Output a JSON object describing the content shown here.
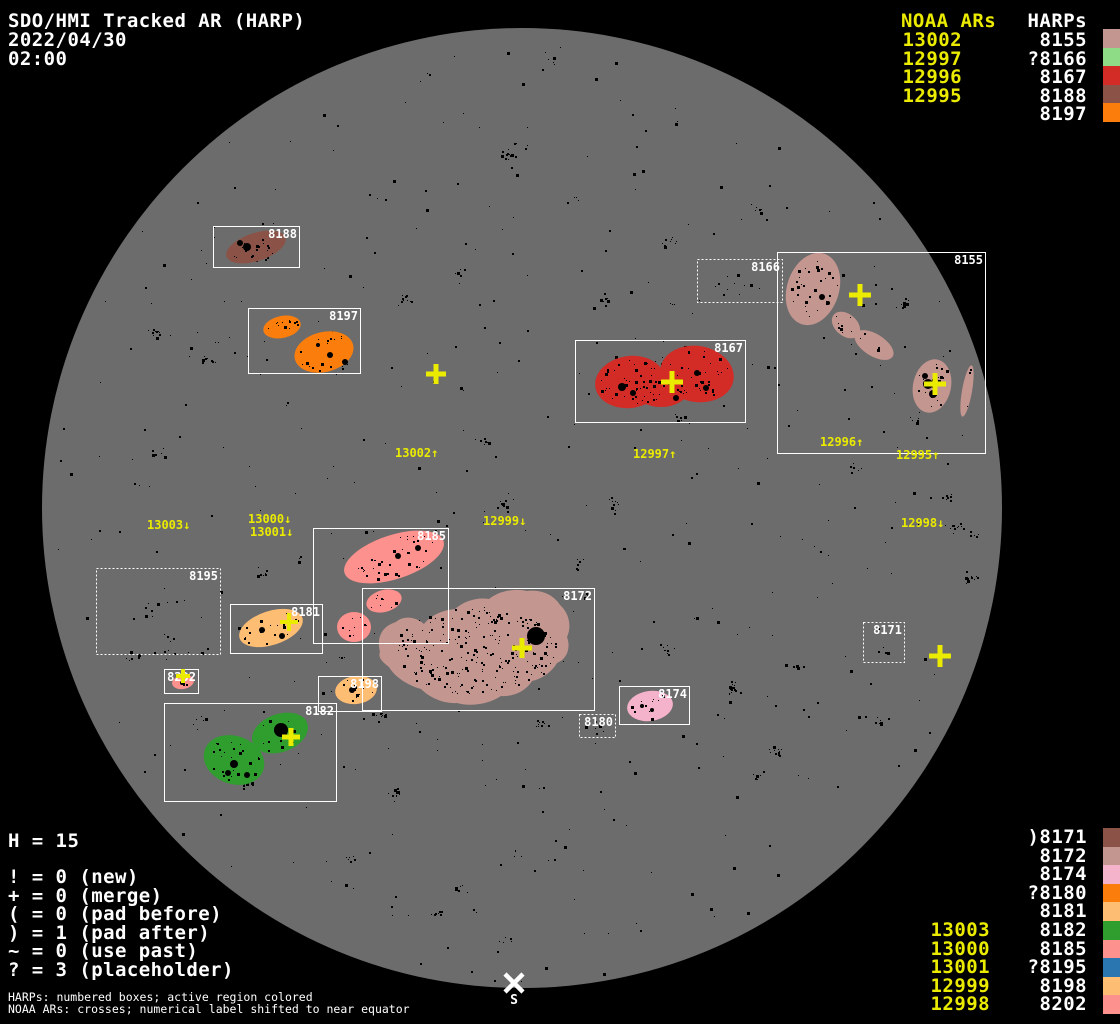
{
  "title": {
    "line1": "SDO/HMI Tracked AR (HARP)",
    "date": "2022/04/30",
    "time": "02:00"
  },
  "colors": {
    "background": "#000000",
    "disk": "#6c6c6c",
    "text": "#ffffff",
    "noaa": "#ebeb00",
    "speckle": "#000000",
    "box_stroke": "#ffffff"
  },
  "palette": {
    "rosybrown": "#c49690",
    "lightgreen": "#8fdc86",
    "red": "#d32b25",
    "sienna": "#8b5347",
    "orange": "#fb7e0d",
    "pink": "#f5b3cb",
    "sandy": "#fdbd73",
    "green": "#2f9e2f",
    "salmon": "#fd918d",
    "steelblue": "#2a76b0"
  },
  "disk": {
    "cx": 522,
    "cy": 508,
    "r": 480
  },
  "legend_top_right": {
    "noaa_header": "NOAA ARs",
    "harp_header": "HARPs",
    "rows": [
      {
        "noaa": "13002",
        "harp": "8155",
        "swatch": "rosybrown"
      },
      {
        "noaa": "12997",
        "harp": "?8166",
        "swatch": "lightgreen"
      },
      {
        "noaa": "12996",
        "harp": "8167",
        "swatch": "red"
      },
      {
        "noaa": "12995",
        "harp": "8188",
        "swatch": "sienna"
      },
      {
        "noaa": "",
        "harp": "8197",
        "swatch": "orange"
      }
    ]
  },
  "legend_bottom_right": {
    "rows": [
      {
        "noaa": "",
        "harp": ")8171",
        "swatch": "sienna"
      },
      {
        "noaa": "",
        "harp": "8172",
        "swatch": "rosybrown"
      },
      {
        "noaa": "",
        "harp": "8174",
        "swatch": "pink"
      },
      {
        "noaa": "",
        "harp": "?8180",
        "swatch": "orange"
      },
      {
        "noaa": "",
        "harp": "8181",
        "swatch": "sandy"
      },
      {
        "noaa": "13003",
        "harp": "8182",
        "swatch": "green"
      },
      {
        "noaa": "13000",
        "harp": "8185",
        "swatch": "salmon"
      },
      {
        "noaa": "13001",
        "harp": "?8195",
        "swatch": "steelblue"
      },
      {
        "noaa": "12999",
        "harp": "8198",
        "swatch": "sandy"
      },
      {
        "noaa": "12998",
        "harp": "8202",
        "swatch": "salmon"
      }
    ]
  },
  "legend_bottom_left": {
    "h_count": "H = 15",
    "stats": [
      "! = 0 (new)",
      "+ = 0 (merge)",
      "( = 0 (pad before)",
      ") = 1 (pad after)",
      "~ = 0 (use past)",
      "? = 3 (placeholder)"
    ],
    "footnote1": "HARPs: numbered boxes; active region colored",
    "footnote2": "NOAA ARs: crosses; numerical label shifted to near equator"
  },
  "south_marker": {
    "label": "S",
    "x": 514,
    "y": 983
  },
  "map": {
    "boxes": [
      {
        "id": "8188",
        "x": 213,
        "y": 226,
        "w": 86,
        "h": 41,
        "dotted": false
      },
      {
        "id": "8197",
        "x": 248,
        "y": 308,
        "w": 112,
        "h": 65,
        "dotted": false
      },
      {
        "id": "8166",
        "x": 697,
        "y": 259,
        "w": 85,
        "h": 43,
        "dotted": true
      },
      {
        "id": "8155",
        "x": 777,
        "y": 252,
        "w": 208,
        "h": 201,
        "dotted": false
      },
      {
        "id": "8167",
        "x": 575,
        "y": 340,
        "w": 170,
        "h": 82,
        "dotted": false
      },
      {
        "id": "8195",
        "x": 96,
        "y": 568,
        "w": 124,
        "h": 86,
        "dotted": true
      },
      {
        "id": "8185",
        "x": 313,
        "y": 528,
        "w": 135,
        "h": 115,
        "dotted": false
      },
      {
        "id": "8181",
        "x": 230,
        "y": 604,
        "w": 92,
        "h": 49,
        "dotted": false
      },
      {
        "id": "8202",
        "x": 164,
        "y": 669,
        "w": 34,
        "h": 24,
        "dotted": false
      },
      {
        "id": "8198",
        "x": 318,
        "y": 676,
        "w": 63,
        "h": 35,
        "dotted": false
      },
      {
        "id": "8182",
        "x": 164,
        "y": 703,
        "w": 172,
        "h": 98,
        "dotted": false
      },
      {
        "id": "8172",
        "x": 362,
        "y": 588,
        "w": 232,
        "h": 122,
        "dotted": false
      },
      {
        "id": "8180",
        "x": 579,
        "y": 714,
        "w": 36,
        "h": 23,
        "dotted": true
      },
      {
        "id": "8174",
        "x": 619,
        "y": 686,
        "w": 70,
        "h": 38,
        "dotted": false
      },
      {
        "id": "8171",
        "x": 863,
        "y": 622,
        "w": 41,
        "h": 40,
        "dotted": true
      }
    ],
    "regions": [
      {
        "harp": "8188",
        "color": "sienna",
        "n": 18,
        "shapes": [
          {
            "t": "e",
            "cx": 256,
            "cy": 247,
            "rx": 31,
            "ry": 14,
            "rot": -18
          }
        ],
        "spots": [
          {
            "x": 247,
            "y": 247,
            "r": 4
          },
          {
            "x": 240,
            "y": 243,
            "r": 3
          }
        ]
      },
      {
        "harp": "8197",
        "color": "orange",
        "n": 30,
        "shapes": [
          {
            "t": "e",
            "cx": 282,
            "cy": 327,
            "rx": 19,
            "ry": 11,
            "rot": -12
          },
          {
            "t": "e",
            "cx": 324,
            "cy": 352,
            "rx": 30,
            "ry": 20,
            "rot": -14
          }
        ],
        "spots": [
          {
            "x": 330,
            "y": 355,
            "r": 3
          },
          {
            "x": 345,
            "y": 362,
            "r": 3
          },
          {
            "x": 318,
            "y": 345,
            "r": 2
          }
        ]
      },
      {
        "harp": "8155",
        "color": "rosybrown",
        "n": 70,
        "shapes": [
          {
            "t": "e",
            "cx": 813,
            "cy": 289,
            "rx": 26,
            "ry": 37,
            "rot": 18
          },
          {
            "t": "e",
            "cx": 846,
            "cy": 325,
            "rx": 16,
            "ry": 11,
            "rot": 40
          },
          {
            "t": "e",
            "cx": 874,
            "cy": 345,
            "rx": 22,
            "ry": 11,
            "rot": 32
          },
          {
            "t": "e",
            "cx": 932,
            "cy": 386,
            "rx": 19,
            "ry": 27,
            "rot": 12
          },
          {
            "t": "e",
            "cx": 967,
            "cy": 391,
            "rx": 5,
            "ry": 26,
            "rot": 10
          }
        ],
        "spots": [
          {
            "x": 822,
            "y": 297,
            "r": 3
          },
          {
            "x": 828,
            "y": 303,
            "r": 2
          },
          {
            "x": 928,
            "y": 384,
            "r": 5
          },
          {
            "x": 933,
            "y": 394,
            "r": 4
          },
          {
            "x": 925,
            "y": 376,
            "r": 3
          }
        ]
      },
      {
        "harp": "8167",
        "color": "red",
        "n": 90,
        "shapes": [
          {
            "t": "e",
            "cx": 630,
            "cy": 382,
            "rx": 35,
            "ry": 26,
            "rot": -8
          },
          {
            "t": "e",
            "cx": 697,
            "cy": 374,
            "rx": 37,
            "ry": 28,
            "rot": 10
          },
          {
            "t": "e",
            "cx": 661,
            "cy": 390,
            "rx": 27,
            "ry": 17,
            "rot": 0
          }
        ],
        "spots": [
          {
            "x": 622,
            "y": 387,
            "r": 4
          },
          {
            "x": 633,
            "y": 393,
            "r": 3
          },
          {
            "x": 697,
            "y": 373,
            "r": 3
          },
          {
            "x": 706,
            "y": 388,
            "r": 3
          },
          {
            "x": 676,
            "y": 398,
            "r": 3
          }
        ]
      },
      {
        "harp": "8185",
        "color": "salmon",
        "n": 55,
        "shapes": [
          {
            "t": "e",
            "cx": 394,
            "cy": 557,
            "rx": 52,
            "ry": 22,
            "rot": -18
          },
          {
            "t": "e",
            "cx": 384,
            "cy": 601,
            "rx": 18,
            "ry": 11,
            "rot": -15
          },
          {
            "t": "e",
            "cx": 354,
            "cy": 627,
            "rx": 17,
            "ry": 15,
            "rot": 0
          }
        ],
        "spots": [
          {
            "x": 398,
            "y": 556,
            "r": 3
          },
          {
            "x": 418,
            "y": 548,
            "r": 3
          }
        ]
      },
      {
        "harp": "8181",
        "color": "sandy",
        "n": 22,
        "shapes": [
          {
            "t": "e",
            "cx": 271,
            "cy": 628,
            "rx": 33,
            "ry": 17,
            "rot": -18
          }
        ],
        "spots": [
          {
            "x": 262,
            "y": 630,
            "r": 3
          },
          {
            "x": 282,
            "y": 636,
            "r": 3
          }
        ]
      },
      {
        "harp": "8202",
        "color": "salmon",
        "n": 3,
        "shapes": [
          {
            "t": "e",
            "cx": 183,
            "cy": 682,
            "rx": 11,
            "ry": 7,
            "rot": -10
          }
        ],
        "spots": [
          {
            "x": 182,
            "y": 683,
            "r": 2
          }
        ]
      },
      {
        "harp": "8198",
        "color": "sandy",
        "n": 14,
        "shapes": [
          {
            "t": "e",
            "cx": 356,
            "cy": 690,
            "rx": 21,
            "ry": 14,
            "rot": -8
          }
        ],
        "spots": [
          {
            "x": 352,
            "y": 690,
            "r": 3
          }
        ]
      },
      {
        "harp": "8182",
        "color": "green",
        "n": 40,
        "shapes": [
          {
            "t": "e",
            "cx": 234,
            "cy": 760,
            "rx": 31,
            "ry": 24,
            "rot": 20
          },
          {
            "t": "e",
            "cx": 280,
            "cy": 733,
            "rx": 29,
            "ry": 19,
            "rot": -20
          }
        ],
        "spots": [
          {
            "x": 281,
            "y": 730,
            "r": 7
          },
          {
            "x": 234,
            "y": 764,
            "r": 4
          },
          {
            "x": 247,
            "y": 775,
            "r": 3
          },
          {
            "x": 228,
            "y": 773,
            "r": 3
          }
        ]
      },
      {
        "harp": "8172",
        "color": "rosybrown",
        "n": 250,
        "shapes": [
          {
            "t": "p",
            "d": "M 380 652 C 376 636, 383 626, 396 622 C 404 615, 416 617, 424 624 C 431 615, 443 610, 455 609 C 464 601, 477 597, 489 599 C 499 591, 514 588, 527 591 C 541 589, 554 595, 560 605 C 569 613, 572 626, 567 637 C 571 648, 567 659, 557 663 C 551 673, 541 679, 532 681 C 526 691, 513 697, 501 696 C 489 704, 471 707, 457 703 C 443 704, 429 697, 421 689 C 407 685, 395 677, 389 667 C 381 661, 378 657, 380 652 Z"
          }
        ],
        "sp_ellipse": {
          "cx": 475,
          "cy": 650,
          "rx": 92,
          "ry": 50,
          "rot": 0
        },
        "spots": [
          {
            "x": 536,
            "y": 636,
            "r": 9
          }
        ]
      },
      {
        "harp": "8174",
        "color": "pink",
        "n": 10,
        "shapes": [
          {
            "t": "e",
            "cx": 650,
            "cy": 706,
            "rx": 23,
            "ry": 15,
            "rot": -8
          }
        ],
        "spots": [
          {
            "x": 642,
            "y": 706,
            "r": 2
          },
          {
            "x": 652,
            "y": 710,
            "r": 2
          }
        ]
      }
    ],
    "extra_speckle_patches": [
      {
        "cx": 737,
        "cy": 282,
        "rx": 35,
        "ry": 15,
        "n": 10
      },
      {
        "cx": 160,
        "cy": 612,
        "rx": 50,
        "ry": 35,
        "n": 14
      },
      {
        "cx": 596,
        "cy": 727,
        "rx": 14,
        "ry": 8,
        "n": 6
      },
      {
        "cx": 884,
        "cy": 643,
        "rx": 16,
        "ry": 14,
        "n": 4
      }
    ],
    "crosses": [
      {
        "noaa": "13002",
        "x": 436,
        "y": 374,
        "s": 10,
        "w": 5
      },
      {
        "noaa": "12997",
        "x": 672,
        "y": 382,
        "s": 11,
        "w": 5
      },
      {
        "noaa": "12996",
        "x": 860,
        "y": 295,
        "s": 11,
        "w": 5
      },
      {
        "noaa": "12995",
        "x": 935,
        "y": 384,
        "s": 11,
        "w": 5
      },
      {
        "noaa": "13000",
        "x": 289,
        "y": 622,
        "s": 9,
        "w": 4
      },
      {
        "noaa": "13001",
        "x": 183,
        "y": 676,
        "s": 7,
        "w": 4
      },
      {
        "noaa": "13003",
        "x": 291,
        "y": 737,
        "s": 9,
        "w": 5
      },
      {
        "noaa": "12999",
        "x": 522,
        "y": 648,
        "s": 10,
        "w": 5
      },
      {
        "noaa": "12998",
        "x": 940,
        "y": 656,
        "s": 11,
        "w": 5
      }
    ],
    "noaa_labels": [
      {
        "text": "13002↑",
        "x": 395,
        "y": 457
      },
      {
        "text": "12997↑",
        "x": 633,
        "y": 458
      },
      {
        "text": "12996↑",
        "x": 820,
        "y": 446
      },
      {
        "text": "12995↑",
        "x": 896,
        "y": 459
      },
      {
        "text": "13003↓",
        "x": 147,
        "y": 529
      },
      {
        "text": "13000↓",
        "x": 248,
        "y": 523
      },
      {
        "text": "13001↓",
        "x": 250,
        "y": 536
      },
      {
        "text": "12999↓",
        "x": 483,
        "y": 525
      },
      {
        "text": "12998↓",
        "x": 901,
        "y": 527
      }
    ]
  },
  "chart_data": {
    "type": "scatter",
    "title": "SDO/HMI Tracked AR (HARP)",
    "datetime": "2022/04/30 02:00",
    "harp_total": 15,
    "flags": {
      "new": 0,
      "merge": 1,
      "pad_before": 0,
      "pad_after": 1,
      "use_past": 0,
      "placeholder": 3
    },
    "noaa_to_harp": [
      [
        "13002",
        "8155"
      ],
      [
        "12997",
        "?8166"
      ],
      [
        "12996",
        "8167"
      ],
      [
        "12995",
        "8188"
      ],
      [
        "",
        "8197"
      ],
      [
        "",
        ")8171"
      ],
      [
        "",
        "8172"
      ],
      [
        "",
        "8174"
      ],
      [
        "",
        "?8180"
      ],
      [
        "",
        "8181"
      ],
      [
        "13003",
        "8182"
      ],
      [
        "13000",
        "8185"
      ],
      [
        "13001",
        "?8195"
      ],
      [
        "12999",
        "8198"
      ],
      [
        "12998",
        "8202"
      ]
    ]
  }
}
